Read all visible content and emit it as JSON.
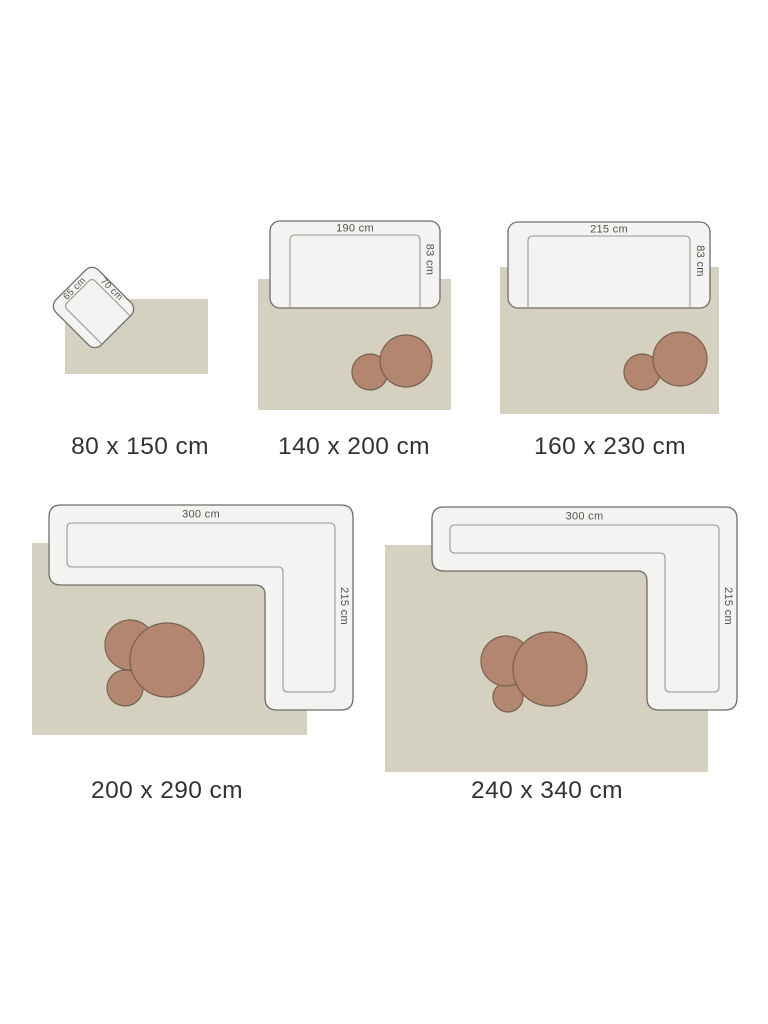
{
  "colors": {
    "background": "#ffffff",
    "rug": "#d4d1c0",
    "furniture_fill": "#f3f3f1",
    "furniture_outline": "#706d69",
    "furniture_inner_line": "#9b9893",
    "pouf_fill": "#b3876f",
    "pouf_outline": "#77604f",
    "dimension_text": "#55524e",
    "caption_text": "#333333"
  },
  "diagrams": [
    {
      "caption": "80 x 150 cm",
      "furniture": "armchair",
      "width_label": "65 cm",
      "depth_label": "70 cm"
    },
    {
      "caption": "140 x 200 cm",
      "furniture": "sofa",
      "width_label": "190 cm",
      "depth_label": "83 cm"
    },
    {
      "caption": "160 x 230 cm",
      "furniture": "sofa",
      "width_label": "215 cm",
      "depth_label": "83 cm"
    },
    {
      "caption": "200 x 290 cm",
      "furniture": "corner-sofa",
      "width_label": "300 cm",
      "depth_label": "215 cm"
    },
    {
      "caption": "240 x 340 cm",
      "furniture": "corner-sofa",
      "width_label": "300 cm",
      "depth_label": "215 cm"
    }
  ]
}
